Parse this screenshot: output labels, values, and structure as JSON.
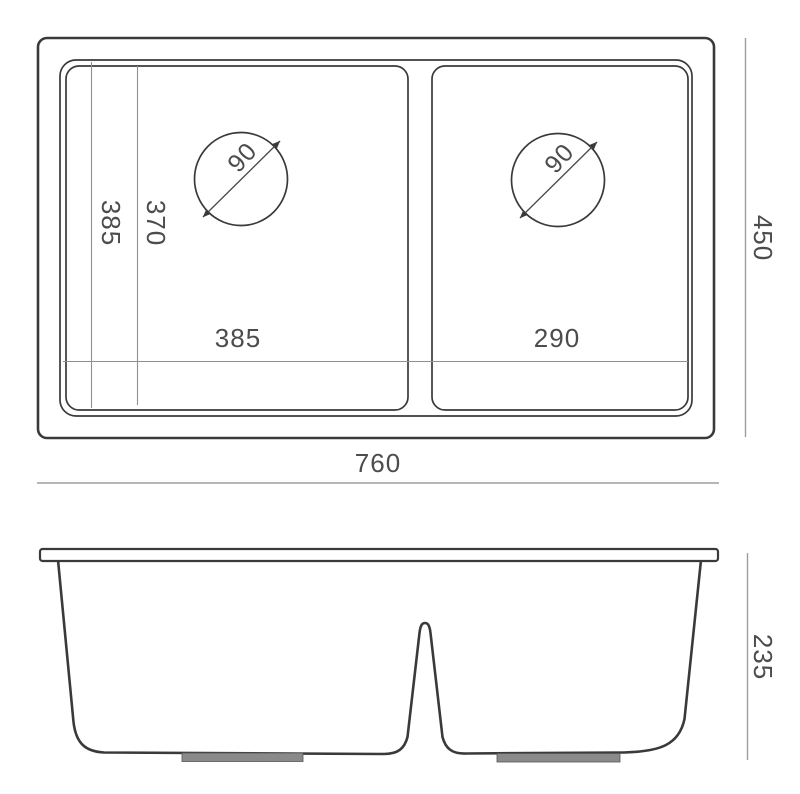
{
  "colors": {
    "outline": "#3a3a3a",
    "dim_line": "#9d9d9d",
    "thin_line": "#8f8f8f",
    "text": "#4c4c4c",
    "foot_pad": "#8a8a8a",
    "background": "#ffffff"
  },
  "top_view": {
    "overall_width": "760",
    "overall_depth": "450",
    "left_bowl_width": "385",
    "right_bowl_width": "290",
    "bowl_depth_outer": "385",
    "bowl_depth_inner": "370",
    "left_drain_diameter": "90",
    "right_drain_diameter": "90"
  },
  "front_view": {
    "overall_height": "235"
  }
}
